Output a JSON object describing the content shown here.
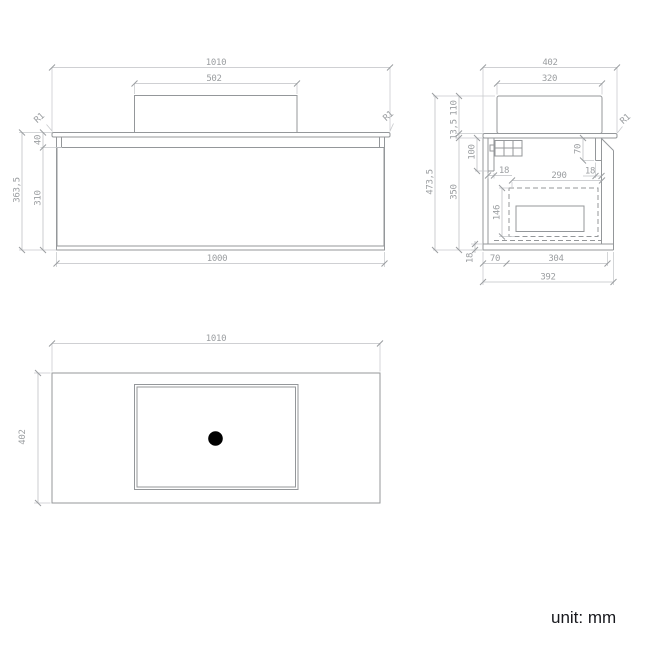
{
  "front_view": {
    "overall_width": "1010",
    "basin_width": "502",
    "cabinet_width": "1000",
    "total_height": "363,5",
    "fluted_height": "310",
    "top_band_height": "40",
    "corner_radius_left": "R1",
    "corner_radius_right": "R1"
  },
  "side_view": {
    "overall_depth": "402",
    "basin_depth": "320",
    "basin_height": "110",
    "countertop_thickness": "13,5",
    "overall_height": "473,5",
    "cabinet_height": "350",
    "back_rail_height": "100",
    "back_panel_thickness": "18",
    "drawer_inner_depth": "290",
    "front_rail_height": "70",
    "front_panel_thickness": "18",
    "drawer_inner_height": "146",
    "bottom_panel_thickness": "18",
    "bottom_offset": "70",
    "bottom_clear_depth": "304",
    "cabinet_depth": "392",
    "corner_radius": "R1"
  },
  "plan_view": {
    "overall_width": "1010",
    "overall_depth": "402"
  },
  "footer": {
    "unit_label": "unit: mm"
  }
}
